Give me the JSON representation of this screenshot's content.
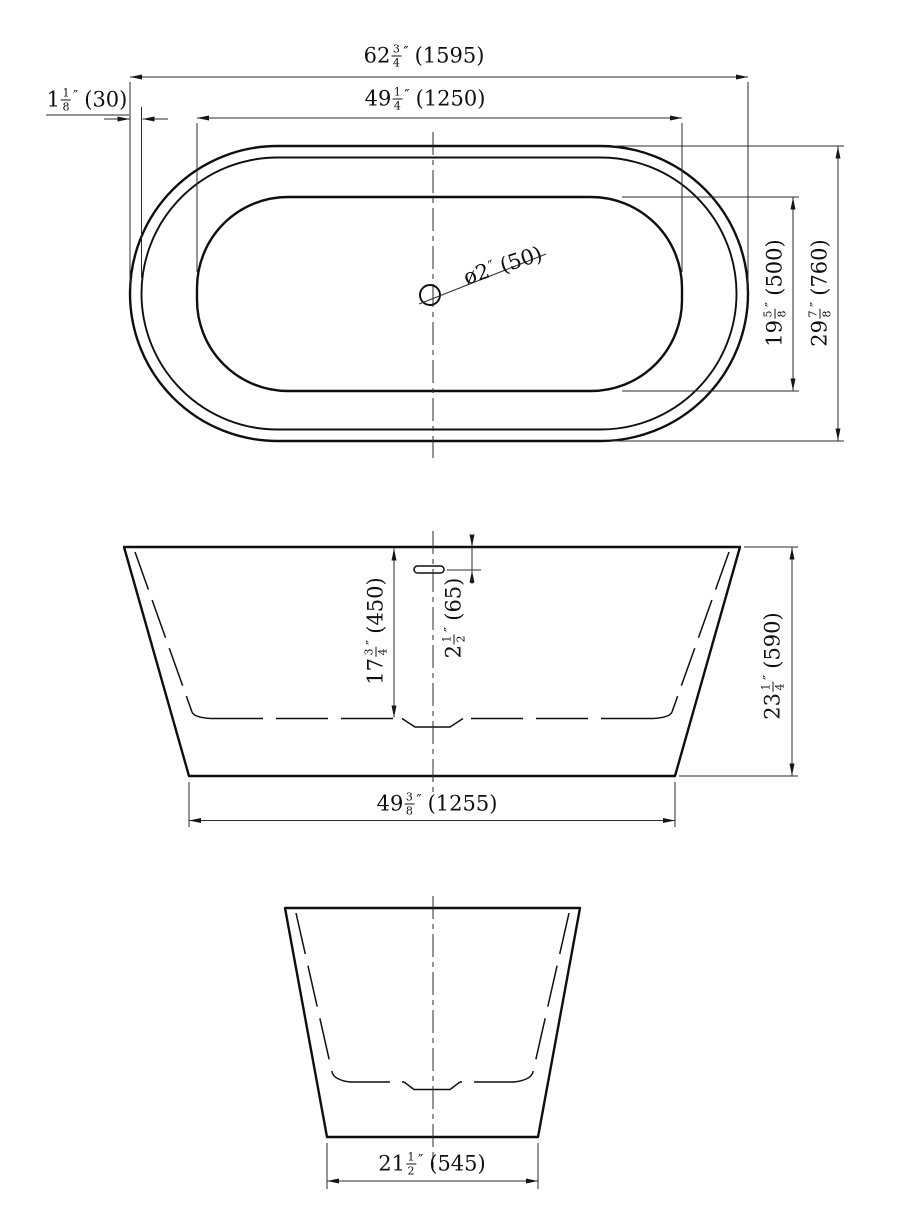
{
  "colors": {
    "line": "#0f0f0f",
    "background": "#ffffff"
  },
  "dimensions": {
    "overall_length": {
      "whole": "62",
      "num": "3",
      "den": "4",
      "unit": "″",
      "mm": "(1595)"
    },
    "basin_length": {
      "whole": "49",
      "num": "1",
      "den": "4",
      "unit": "″",
      "mm": "(1250)"
    },
    "rim_width": {
      "whole": "1",
      "num": "1",
      "den": "8",
      "unit": "″",
      "mm": "(30)"
    },
    "drain_diameter": {
      "whole": "ø2",
      "unit": "″",
      "mm": "(50)"
    },
    "basin_width": {
      "whole": "19",
      "num": "5",
      "den": "8",
      "unit": "″",
      "mm": "(500)"
    },
    "overall_width": {
      "whole": "29",
      "num": "7",
      "den": "8",
      "unit": "″",
      "mm": "(760)"
    },
    "interior_depth": {
      "whole": "17",
      "num": "3",
      "den": "4",
      "unit": "″",
      "mm": "(450)"
    },
    "overflow_height": {
      "whole": "2",
      "num": "1",
      "den": "2",
      "unit": "″",
      "mm": "(65)"
    },
    "overall_height": {
      "whole": "23",
      "num": "1",
      "den": "4",
      "unit": "″",
      "mm": "(590)"
    },
    "base_length": {
      "whole": "49",
      "num": "3",
      "den": "8",
      "unit": "″",
      "mm": "(1255)"
    },
    "base_width": {
      "whole": "21",
      "num": "1",
      "den": "2",
      "unit": "″",
      "mm": "(545)"
    }
  }
}
